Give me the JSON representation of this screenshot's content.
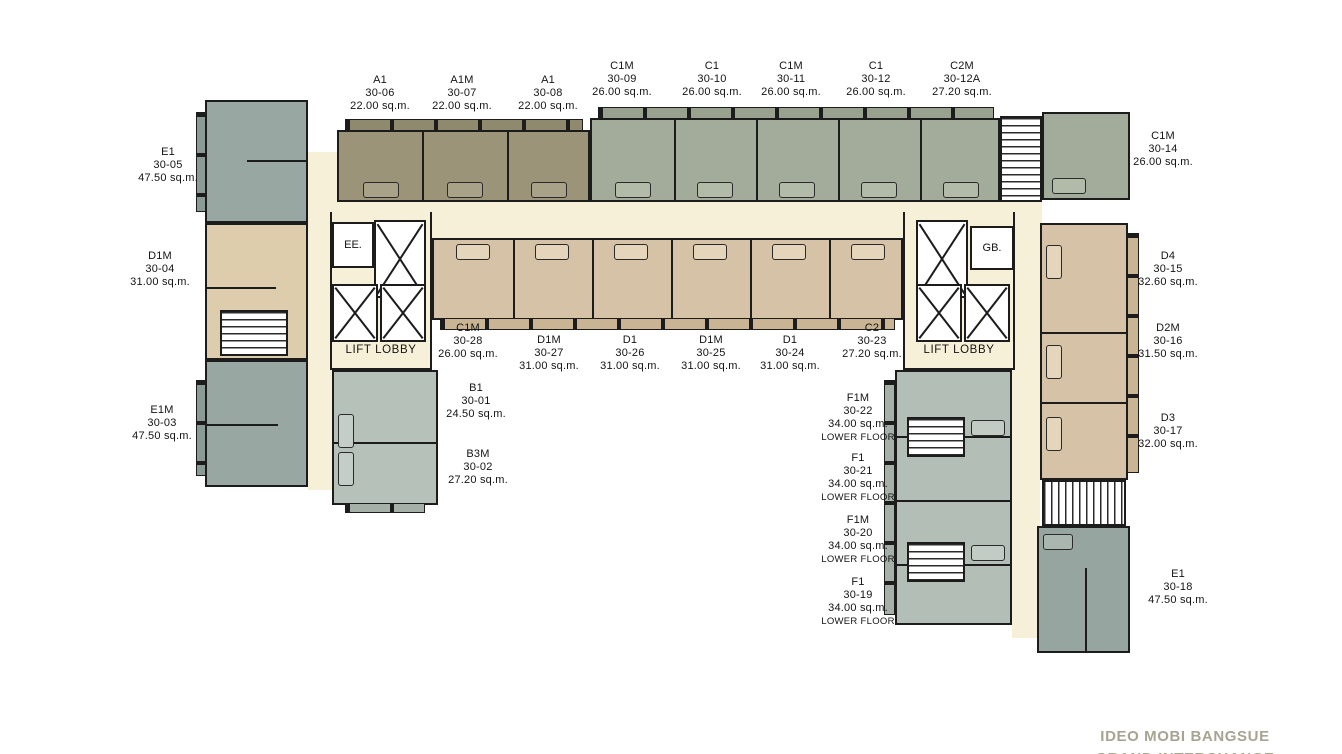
{
  "title": {
    "line1": "IDEO MOBI BANGSUE",
    "line2": "GRAND INTERCHANGE"
  },
  "labels": {
    "lift_lobby": "LIFT LOBBY",
    "ee": "EE.",
    "gb": "GB."
  },
  "colors": {
    "corridor": "#f6f0d8",
    "a_units": "#9b9479",
    "c_units": "#a3ac9b",
    "e_units": "#98a7a1",
    "d_units": "#d6c2a6",
    "b_f_units": "#b6c1b9",
    "walls": "#1c1c1c",
    "title_text": "#a6a492"
  },
  "units": [
    {
      "type": "A1",
      "number": "30-06",
      "area": "22.00 sq.m."
    },
    {
      "type": "A1M",
      "number": "30-07",
      "area": "22.00 sq.m."
    },
    {
      "type": "A1",
      "number": "30-08",
      "area": "22.00 sq.m."
    },
    {
      "type": "C1M",
      "number": "30-09",
      "area": "26.00 sq.m."
    },
    {
      "type": "C1",
      "number": "30-10",
      "area": "26.00 sq.m."
    },
    {
      "type": "C1M",
      "number": "30-11",
      "area": "26.00 sq.m."
    },
    {
      "type": "C1",
      "number": "30-12",
      "area": "26.00 sq.m."
    },
    {
      "type": "C2M",
      "number": "30-12A",
      "area": "27.20 sq.m."
    },
    {
      "type": "C1M",
      "number": "30-14",
      "area": "26.00 sq.m."
    },
    {
      "type": "E1",
      "number": "30-05",
      "area": "47.50 sq.m."
    },
    {
      "type": "D1M",
      "number": "30-04",
      "area": "31.00 sq.m."
    },
    {
      "type": "E1M",
      "number": "30-03",
      "area": "47.50 sq.m."
    },
    {
      "type": "C1M",
      "number": "30-28",
      "area": "26.00 sq.m."
    },
    {
      "type": "D1M",
      "number": "30-27",
      "area": "31.00 sq.m."
    },
    {
      "type": "D1",
      "number": "30-26",
      "area": "31.00 sq.m."
    },
    {
      "type": "D1M",
      "number": "30-25",
      "area": "31.00 sq.m."
    },
    {
      "type": "D1",
      "number": "30-24",
      "area": "31.00 sq.m."
    },
    {
      "type": "C2",
      "number": "30-23",
      "area": "27.20 sq.m."
    },
    {
      "type": "B1",
      "number": "30-01",
      "area": "24.50 sq.m."
    },
    {
      "type": "B3M",
      "number": "30-02",
      "area": "27.20 sq.m."
    },
    {
      "type": "F1M",
      "number": "30-22",
      "area": "34.00 sq.m.",
      "note": "LOWER FLOOR"
    },
    {
      "type": "F1",
      "number": "30-21",
      "area": "34.00 sq.m.",
      "note": "LOWER FLOOR"
    },
    {
      "type": "F1M",
      "number": "30-20",
      "area": "34.00 sq.m.",
      "note": "LOWER FLOOR"
    },
    {
      "type": "F1",
      "number": "30-19",
      "area": "34.00 sq.m.",
      "note": "LOWER FLOOR"
    },
    {
      "type": "D4",
      "number": "30-15",
      "area": "32.60 sq.m."
    },
    {
      "type": "D2M",
      "number": "30-16",
      "area": "31.50 sq.m."
    },
    {
      "type": "D3",
      "number": "30-17",
      "area": "32.00 sq.m."
    },
    {
      "type": "E1",
      "number": "30-18",
      "area": "47.50 sq.m."
    }
  ]
}
